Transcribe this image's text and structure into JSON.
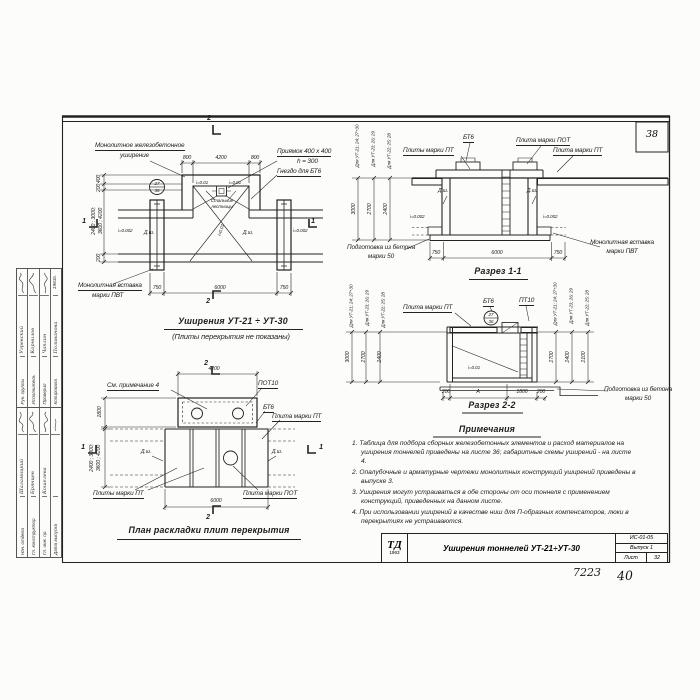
{
  "sheet": {
    "corner_no": "38",
    "archive_no": "7223",
    "page_no": "40"
  },
  "plan_top": {
    "mono1": "Монолитное железобетонное",
    "mono2": "уширение",
    "pit1": "Приямок 400 х 400",
    "pit2": "h = 300",
    "socket": "Гнездо для БТ6",
    "ins1": "Монолитная вставка",
    "ins2": "марки ПВТ",
    "steps1": "Стальные",
    "steps2": "лестницы",
    "slope_a": "i=0.01",
    "slope_b": "i=0.01",
    "slope_c": "i=0.01",
    "slope_l": "i=0.002",
    "slope_r": "i=0.002",
    "dsh_l": "Д.ш.",
    "dsh_r": "Д.ш.",
    "node_t": "27",
    "node_b": "36",
    "d800a": "800",
    "d4200": "4200",
    "d800b": "800",
    "d750a": "750",
    "d6000": "6000",
    "d750b": "750",
    "v400": "400",
    "v200a": "200",
    "vbig1": "2400 ; 3000;",
    "vbig2": "3600 ; 4200",
    "v200b": "200",
    "m2t": "2",
    "m2b": "2",
    "m1l": "1",
    "m1r": "1",
    "title": "Уширения  УТ-21 ÷ УТ-30",
    "subtitle": "(Плиты перекрытия не показаны)"
  },
  "section1": {
    "pt_l": "Плиты марки ПТ",
    "bt6": "БТ6",
    "pot": "Плита марки ПОТ",
    "pt_r": "Плита марки ПТ",
    "dsh_l": "Д.ш.",
    "dsh_r": "Д.ш.",
    "slope_l": "i=0.002",
    "slope_r": "i=0.002",
    "g1": "Для УТ-21; 24; 27÷30",
    "g2": "Для УТ-23; 26; 29",
    "g3": "Для УТ-22; 25; 28",
    "d3000": "3000",
    "d2700": "2700",
    "d2400": "2400",
    "prep1": "Подготовка из бетона",
    "prep2": "марки 50",
    "ins1": "Монолитная вставка",
    "ins2": "марки ПВТ",
    "d750a": "750",
    "d6000": "6000",
    "d750b": "750",
    "title": "Разрез 1-1"
  },
  "section2": {
    "pt": "Плита марки ПТ",
    "bt6": "БТ6",
    "pt10": "ПТ10",
    "node_t": "27",
    "node_b": "36",
    "slope": "i=0.01",
    "lg1": "Для УТ-21; 24; 27÷30",
    "lg2": "Для УТ-23; 26; 29",
    "lg3": "Для УТ-22; 25; 28",
    "ld1": "3000",
    "ld2": "2700",
    "ld3": "2400",
    "rg1": "Для УТ-21; 24; 27÷30",
    "rg2": "Для УТ-23; 26; 29",
    "rg3": "Для УТ-22; 25; 28",
    "rd1": "2700",
    "rd2": "2400",
    "rd3": "2100",
    "d200a": "200",
    "dA": "А",
    "d1800": "1800",
    "d200b": "200",
    "prep1": "Подготовка из бетона",
    "prep2": "марки 50",
    "title": "Разрез 2-2"
  },
  "plan_bottom": {
    "note4": "См. примечание 4",
    "pot10": "ПОТ10",
    "bt6": "БТ6",
    "pt_r": "Плита марки ПТ",
    "dsh_l": "Д.ш.",
    "dsh_r": "Д.ш.",
    "pt_b": "Плиты марки ПТ",
    "pot_b": "Плита марки ПОТ",
    "d4200": "4200",
    "d1800": "1800",
    "vbig1": "2400 ; 3000;",
    "vbig2": "3600 ; 4200",
    "d6000": "6000",
    "m1l": "1",
    "m1r": "1",
    "m2t": "2",
    "m2b": "2",
    "title": "План раскладки плит перекрытия"
  },
  "notes": {
    "title": "Примечания",
    "items": [
      "1. Таблица для подбора сборных железобетонных элементов и расход материалов на уширения тоннелей приведены на листе 36; габаритные схемы уширений - на листе 4.",
      "2. Опалубочные и арматурные чертежи монолитных конструкций уширений приведены в выпуске 3.",
      "3. Уширения могут устраиваться в обе стороны от оси тоннеля с применением конструкций, приведенных на данном листе.",
      "4. При использовании уширений в качестве ниш для П-образных компенсаторов, люки в перекрытиях не устраиваются."
    ]
  },
  "titleblock": {
    "logo_top": "ТД",
    "logo_year": "1963",
    "title": "Уширения тоннелей УТ-21÷УТ-30",
    "code": "ИС-01-05",
    "issue": "Выпуск 1",
    "sheet_label": "Лист",
    "sheet_no": "32"
  },
  "stamp": {
    "rows_a": [
      {
        "role": "Нач. отдела",
        "name": "Шаламицкий"
      },
      {
        "role": "Гл. конструктор",
        "name": "Брянцев"
      },
      {
        "role": "Гл. инж. пр.",
        "name": "Кошелева"
      },
      {
        "role": "Дата выпуска",
        "name": ""
      }
    ],
    "rows_b": [
      {
        "role": "Рук. группы",
        "name": "Угревский"
      },
      {
        "role": "Исполнитель",
        "name": "Корнилов"
      },
      {
        "role": "Проверил",
        "name": "Чаплин"
      },
      {
        "role": "Копировала",
        "name": "Поливанова"
      }
    ],
    "year": "1963г."
  }
}
